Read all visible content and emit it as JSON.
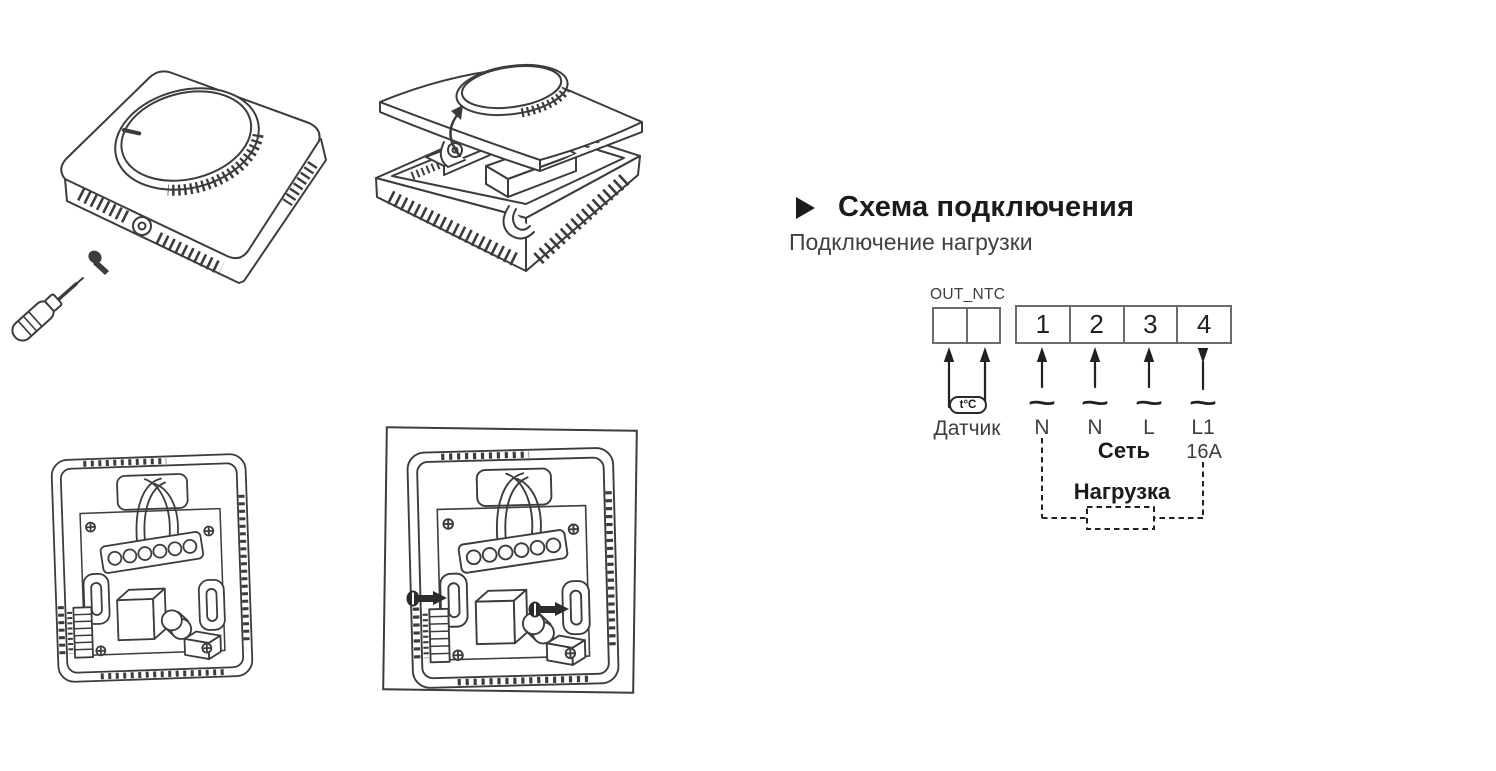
{
  "section": {
    "title": "Схема подключения",
    "subtitle": "Подключение нагрузки"
  },
  "wiring": {
    "connector_label": "OUT_NTC",
    "terminals": [
      "1",
      "2",
      "3",
      "4"
    ],
    "sensor_symbol": "t°C",
    "sensor_label": "Датчик",
    "ac_symbol": "~",
    "wire_labels": [
      "N",
      "N",
      "L",
      "L1"
    ],
    "mains_label": "Сеть",
    "breaker_label": "16A",
    "load_label": "Нагрузка"
  },
  "icons": {
    "section_bullet": "right-pointing-triangle",
    "terminal_flow": "up-arrow",
    "output_flow": "down-arrow"
  },
  "colors": {
    "ink": "#231f20",
    "terminal_box_line": "#6b6c6e",
    "drawing_line": "#3c3c3e",
    "background": "#ffffff"
  }
}
